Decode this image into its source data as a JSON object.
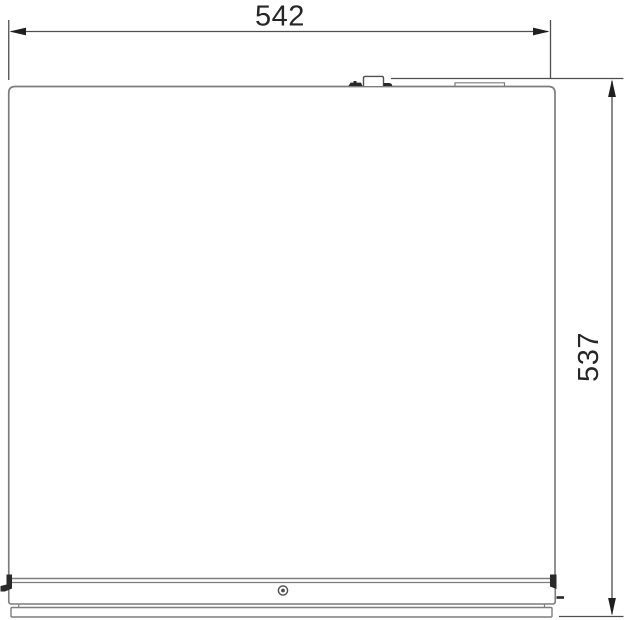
{
  "dimensions": {
    "width": {
      "label": "542"
    },
    "height": {
      "label": "537"
    }
  },
  "colors": {
    "background": "#ffffff",
    "panel_outline": "#7d7d7d",
    "dimension_line": "#4f4f4f",
    "arrow": "#1f1f1f",
    "label_text": "#262626",
    "detail_dark": "#2a2a2a"
  }
}
